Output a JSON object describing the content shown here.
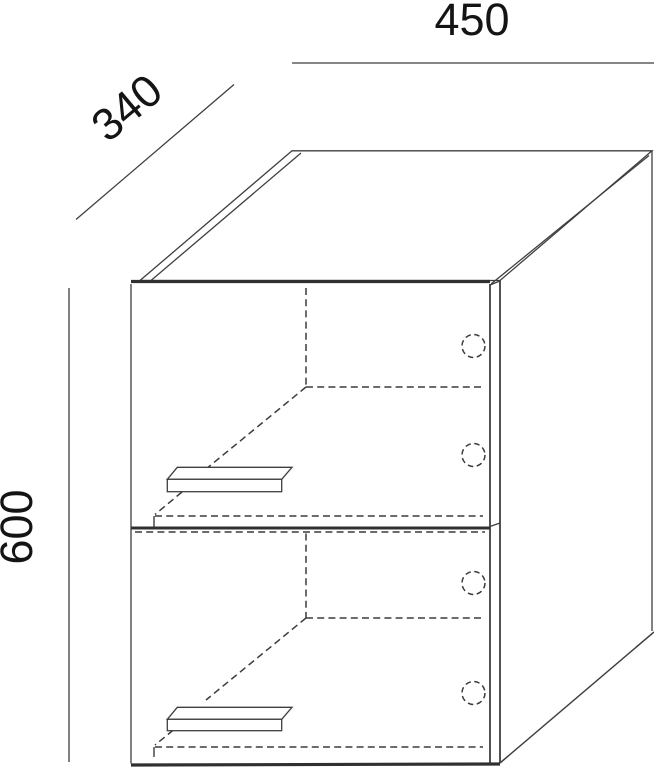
{
  "drawing": {
    "dimension_labels": {
      "width_mm": "450",
      "depth_mm": "340",
      "height_mm": "600"
    },
    "style": {
      "line_color": "#3f3f3f",
      "heavy_line_color": "#303030",
      "hidden_line_color": "#3c3c3c",
      "text_color": "#141414",
      "background": "#ffffff"
    }
  }
}
